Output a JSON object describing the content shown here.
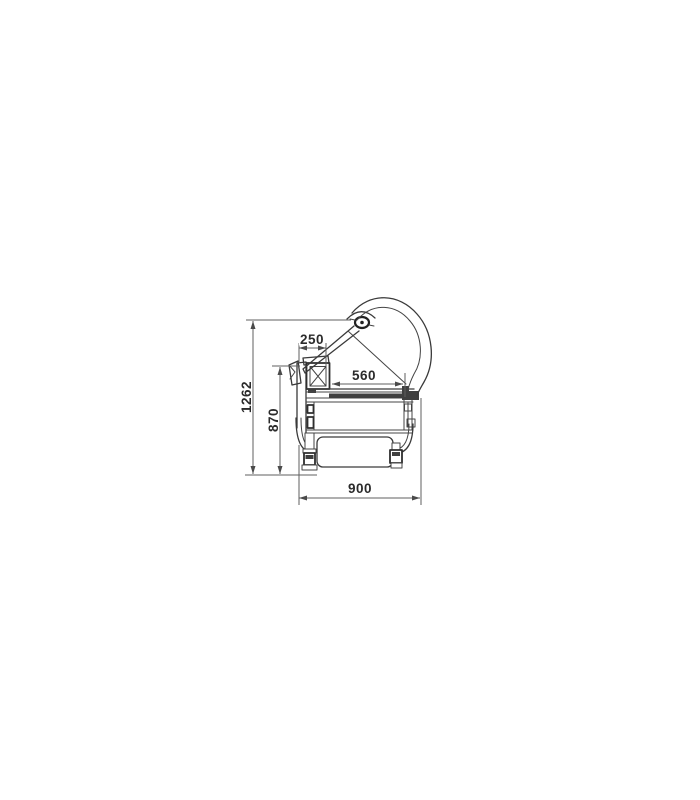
{
  "drawing": {
    "dimensions": {
      "overall_height": "1262",
      "body_height": "870",
      "top_width": "250",
      "deck_depth": "560",
      "overall_depth": "900"
    },
    "colors": {
      "background": "#ffffff",
      "structure_line": "#3a3a3a",
      "dimension_line": "#5f5f5f",
      "label_text": "#2b2b2b"
    }
  }
}
